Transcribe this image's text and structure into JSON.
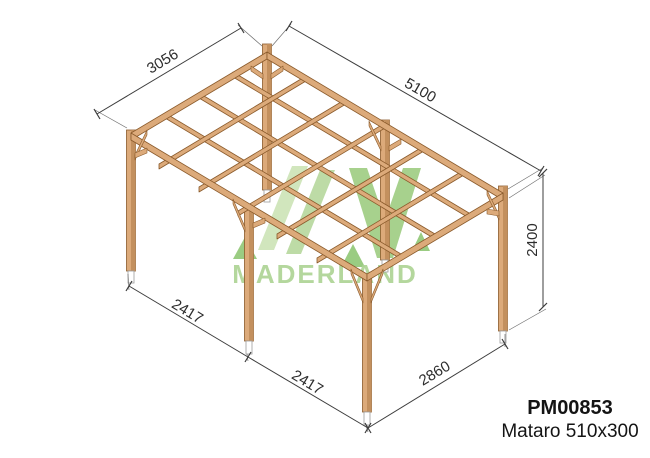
{
  "watermark": {
    "brand": "MADERLAND"
  },
  "product": {
    "code": "PM00853",
    "name": "Mataro 510x300"
  },
  "dimensions": {
    "roof_side_left": "3056",
    "roof_side_right": "5100",
    "post_height": "2400",
    "bay_left_1": "2417",
    "bay_left_2": "2417",
    "front_span": "2860"
  },
  "colors": {
    "wood": "#dcaa7a",
    "wood_dark": "#c3905e",
    "wood_outline": "#8a5a2b",
    "dimension": "#3c3c3c",
    "logo_green": "#a3cf87",
    "logo_light": "#cbe3b4",
    "logo_mid": "#b4d79a",
    "logo_dark": "#9bcb7e",
    "logo_pine": "#8dc571"
  }
}
